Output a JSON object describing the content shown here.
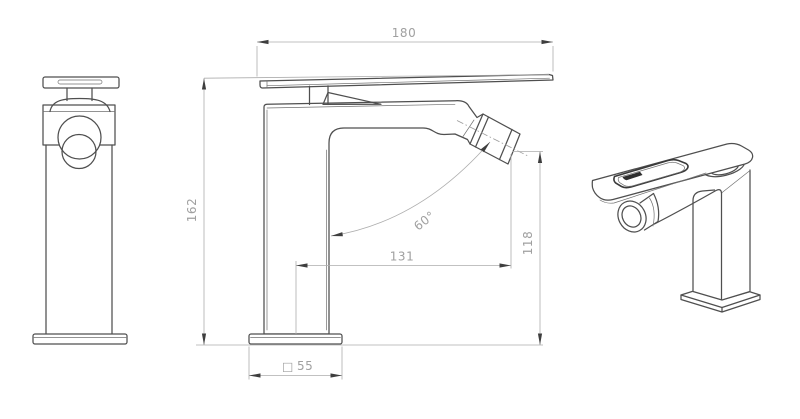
{
  "drawing": {
    "background": "#ffffff",
    "object_line_color": "#4f4f4f",
    "dimension_line_color": "#adadad",
    "text_color": "#a0a0a0"
  },
  "dims": {
    "handle_length": "180",
    "overall_height": "162",
    "spout_reach": "131",
    "outlet_height": "118",
    "spray_angle": "60°",
    "base_symbol": "□",
    "base_size": "55"
  }
}
